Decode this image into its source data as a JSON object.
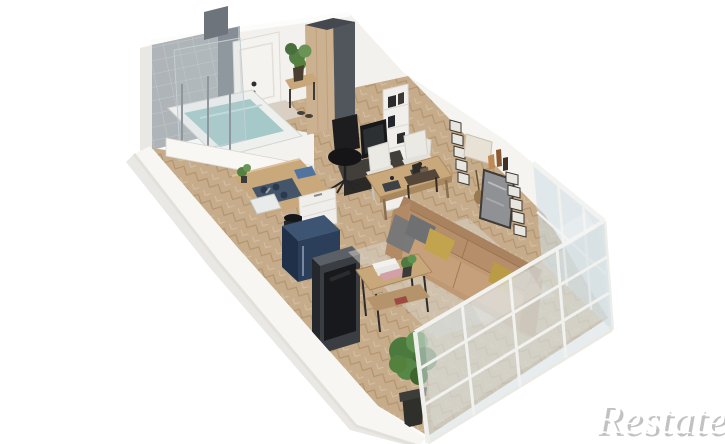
{
  "watermark": {
    "text": "Restate"
  },
  "scene": {
    "type": "isometric-3d-floor-plan-render",
    "unit": "studio-apartment",
    "rooms": [
      {
        "name": "bathroom",
        "items": [
          "bathtub",
          "shower-columns",
          "glass-screen",
          "tiled-wall"
        ]
      },
      {
        "name": "entry-hall",
        "items": [
          "entrance-door",
          "wardrobe",
          "bench",
          "potted-plant",
          "shoes",
          "doormat"
        ]
      },
      {
        "name": "kitchen",
        "items": [
          "counter",
          "cooktop",
          "sink",
          "cutting-board",
          "base-cabinet",
          "navy-cabinet",
          "black-pot"
        ]
      },
      {
        "name": "living-dining",
        "items": [
          "bookshelf",
          "desk",
          "monitor",
          "office-chair",
          "dining-table",
          "dining-chairs",
          "plates",
          "sofa",
          "pillows",
          "rug",
          "console-table",
          "coffee-table",
          "books",
          "wall-art",
          "floor-plant",
          "tv-panel"
        ]
      },
      {
        "name": "glazed-facade",
        "items": [
          "corner-glazing",
          "window-grid"
        ]
      }
    ],
    "colors": {
      "background": "#ffffff",
      "walls": "#f4f2ef",
      "floor_wood": "#c6ac8a",
      "tile": "#aeb4b8",
      "sofa": "#bf9973",
      "navy_cabinet": "#2b3f5a",
      "counter_wood": "#c9a87c",
      "tv_panel": "#3a3e43",
      "glass": "#cdd9dd",
      "plant_green": "#4c7a3e",
      "watermark_gray": "#c2c2c2"
    }
  }
}
